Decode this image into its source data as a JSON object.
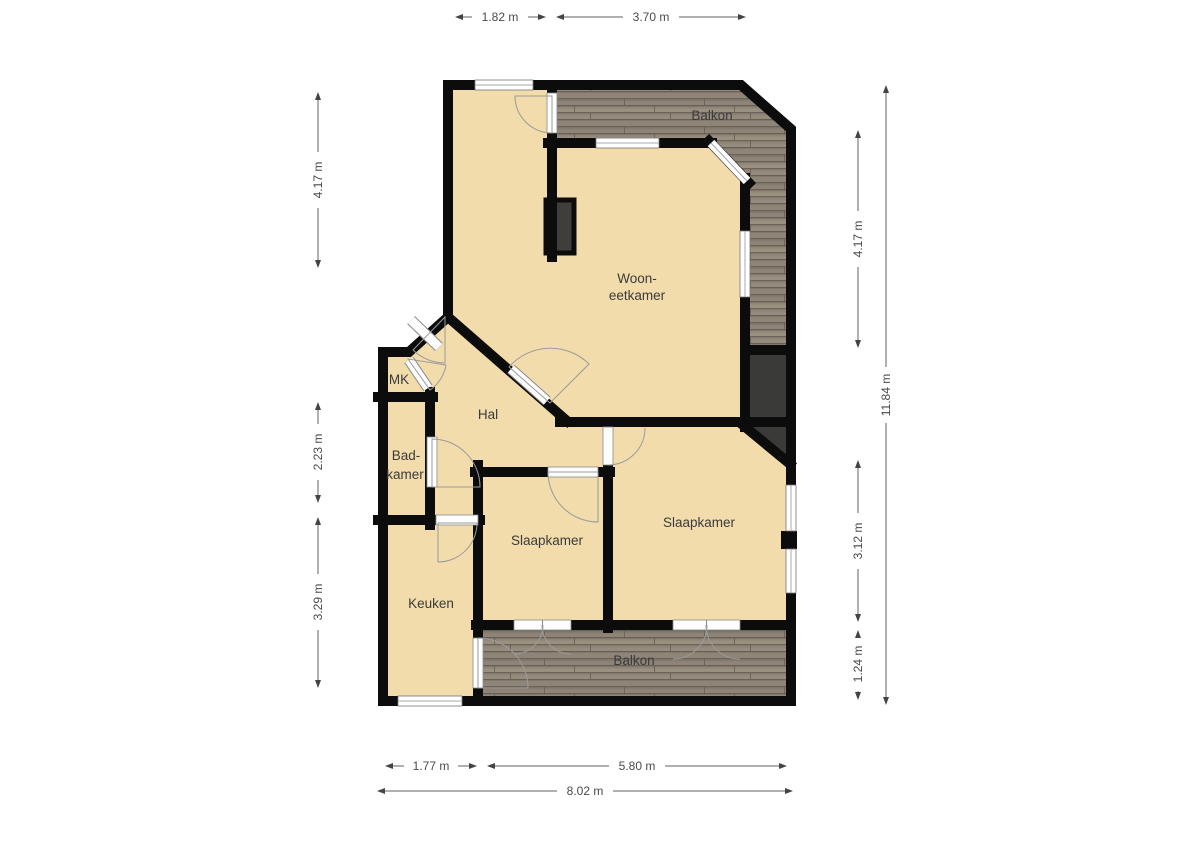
{
  "page": {
    "type": "apartment-floorplan",
    "background": "#ffffff"
  },
  "rooms": {
    "balkon_top": "Balkon",
    "woonkamer_line1": "Woon-",
    "woonkamer_line2": "eetkamer",
    "mk": "MK",
    "hal": "Hal",
    "badkamer_line1": "Bad-",
    "badkamer_line2": "kamer",
    "slaapkamer_mid": "Slaapkamer",
    "slaapkamer_right": "Slaapkamer",
    "keuken": "Keuken",
    "balkon_bottom": "Balkon"
  },
  "dims": {
    "top1": "1.82 m",
    "top2": "3.70 m",
    "left1": "4.17 m",
    "left2": "2.23 m",
    "left3": "3.29 m",
    "right1": "4.17 m",
    "right2": "3.12 m",
    "right3": "1.24 m",
    "right_total": "11.84 m",
    "bottom1": "1.77 m",
    "bottom2": "5.80 m",
    "bottom_total": "8.02 m"
  },
  "colors": {
    "floor": "#f2dcab",
    "wall": "#0c0c0c",
    "balcony_deck": "#8e8477",
    "deck_seam": "#6b645a",
    "shaft": "#3a3a38",
    "window": "#ffffff",
    "dimension_text": "#4a4a4a",
    "room_label_text": "#3b3b3b"
  }
}
